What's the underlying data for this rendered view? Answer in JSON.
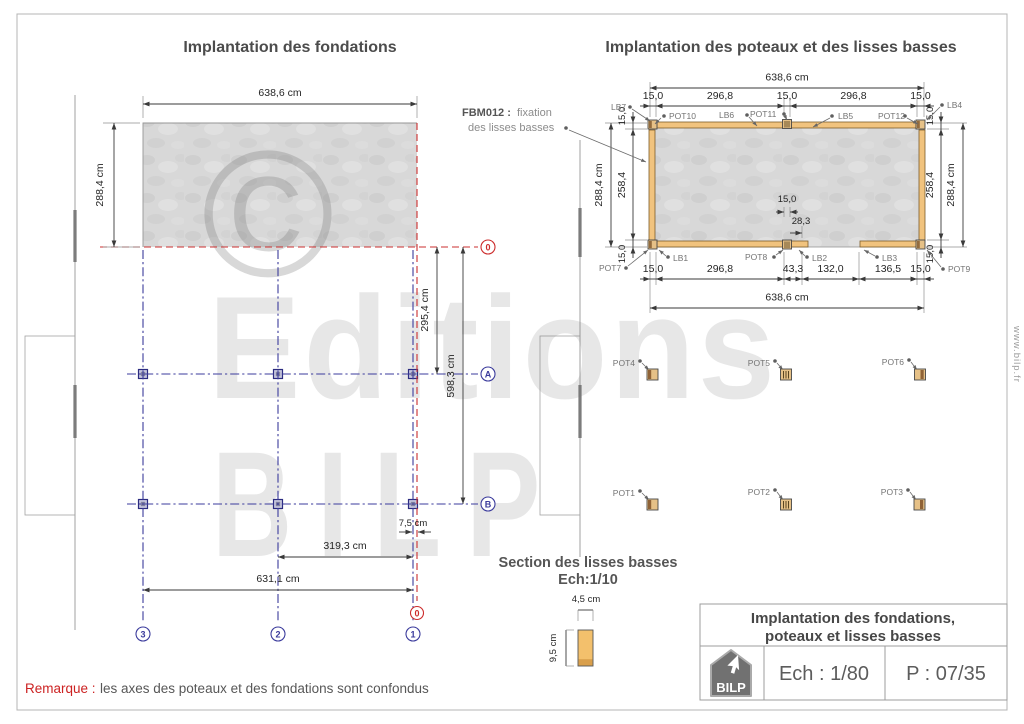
{
  "page": {
    "left_title": "Implantation des fondations",
    "right_title": "Implantation des poteaux et des lisses basses",
    "remark_label": "Remarque :",
    "remark_text": "les axes des poteaux et des fondations sont confondus",
    "website": "www.bilp.fr"
  },
  "watermark": {
    "symbol": "©",
    "line1": "Editions",
    "line2": "BILP"
  },
  "foundations": {
    "dim_width": "638,6 cm",
    "dim_height": "288,4 cm",
    "dim_zero_to_a": "295,4 cm",
    "dim_zero_to_b": "598,3 cm",
    "dim_offset": "7,5 cm",
    "dim_axis2_to_1": "319,3 cm",
    "dim_axis3_to_1": "631,1 cm",
    "axis_h0": "0",
    "axis_a": "A",
    "axis_b": "B",
    "axis_v0": "0",
    "axis_v1": "1",
    "axis_v2": "2",
    "axis_v3": "3"
  },
  "implantation": {
    "dim_width": "638,6 cm",
    "dim_15": "15,0",
    "dim_2968": "296,8",
    "dim_433": "43,3",
    "dim_1320": "132,0",
    "dim_1365": "136,5",
    "dim_2584": "258,4",
    "dim_2884": "288,4 cm",
    "dim_283": "28,3",
    "annotation_code": "FBM012 :",
    "annotation_text": "fixation",
    "annotation_line2": "des lisses basses",
    "lb1": "LB1",
    "lb2": "LB2",
    "lb3": "LB3",
    "lb4": "LB4",
    "lb5": "LB5",
    "lb6": "LB6",
    "lb7": "LB7",
    "pot1": "POT1",
    "pot2": "POT2",
    "pot3": "POT3",
    "pot4": "POT4",
    "pot5": "POT5",
    "pot6": "POT6",
    "pot7": "POT7",
    "pot8": "POT8",
    "pot9": "POT9",
    "pot10": "POT10",
    "pot11": "POT11",
    "pot12": "POT12"
  },
  "section": {
    "title": "Section des lisses basses",
    "scale": "Ech:1/10",
    "dim_width": "4,5 cm",
    "dim_height": "9,5 cm"
  },
  "titleblock": {
    "title_line1": "Implantation des fondations,",
    "title_line2": "poteaux et lisses basses",
    "scale": "Ech : 1/80",
    "page_number": "P : 07/35",
    "logo": "BILP"
  }
}
